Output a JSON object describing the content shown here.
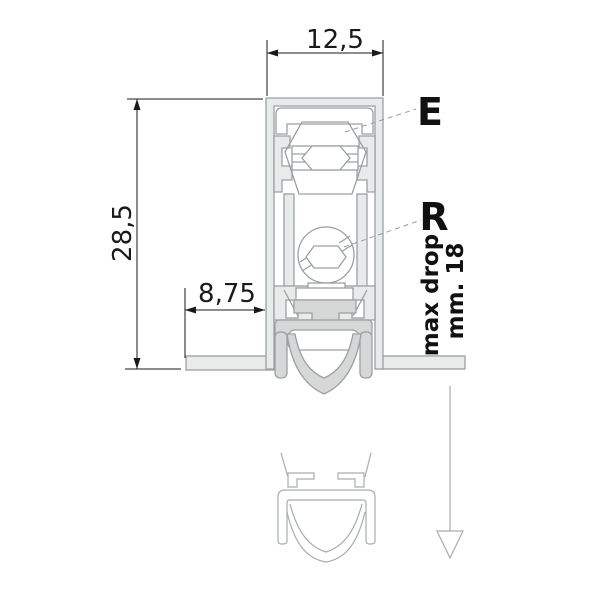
{
  "figure": {
    "dimensions": {
      "top_width": "12,5",
      "left_height": "28,5",
      "inset_width": "8,75"
    },
    "part_labels": {
      "e": "E",
      "r": "R"
    },
    "annotation": {
      "line1": "max drop",
      "line2": "mm. 18"
    },
    "icons": {
      "drop_direction": "arrow-down"
    },
    "colors": {
      "profile_fill": "#e9eaea",
      "accent_fill": "#d6d8d8",
      "outline": "#9aa0a3",
      "dimension": "#1a1a1a",
      "background": "#ffffff"
    }
  }
}
